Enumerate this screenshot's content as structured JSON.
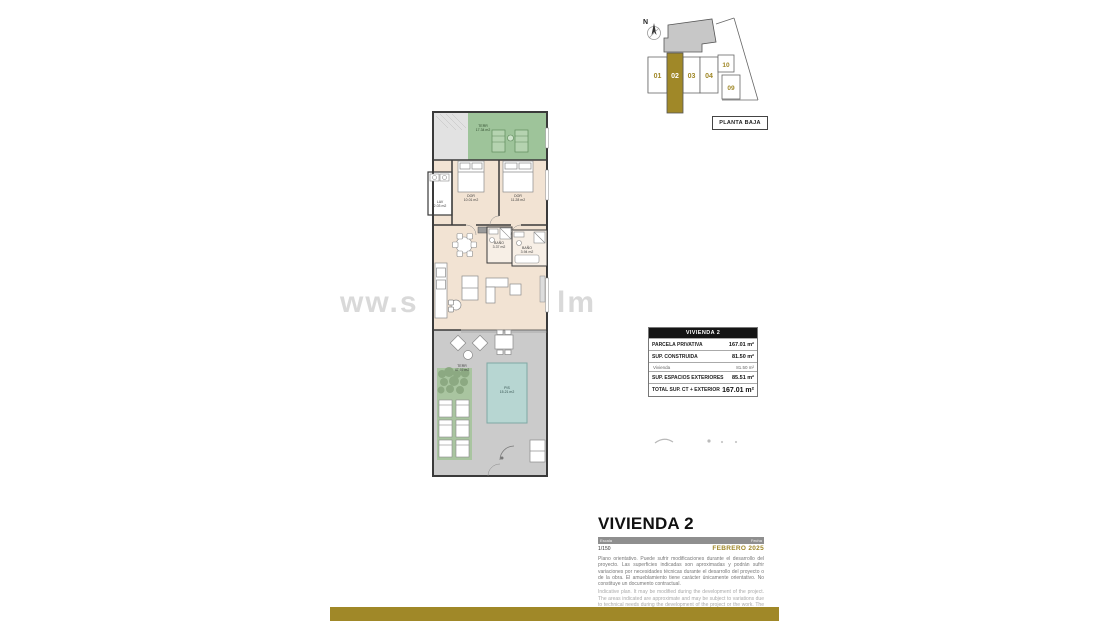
{
  "keyplan": {
    "north_label": "N",
    "units": [
      {
        "label": "01",
        "highlighted": false
      },
      {
        "label": "02",
        "highlighted": true
      },
      {
        "label": "03",
        "highlighted": false
      },
      {
        "label": "04",
        "highlighted": false
      },
      {
        "label": "10",
        "highlighted": false
      },
      {
        "label": "09",
        "highlighted": false
      }
    ],
    "floor_label": "PLANTA BAJA"
  },
  "plan": {
    "rooms": {
      "terrace_top": {
        "name": "TERR",
        "area": "17.34 m2"
      },
      "bedroom_left": {
        "name": "DOR",
        "area": "10.01 m2"
      },
      "bedroom_right": {
        "name": "DOR",
        "area": "11.28 m2"
      },
      "laundry": {
        "name": "LAV",
        "area": "2.03 m2"
      },
      "bath_small": {
        "name": "BAÑO",
        "area": "3.37 m2"
      },
      "bath_main": {
        "name": "BAÑO",
        "area": "3.94 m2"
      },
      "terrace_bottom": {
        "name": "TERR",
        "area": "47.97 m2"
      },
      "pool": {
        "name": "PIS",
        "area": "15.21 m2"
      }
    }
  },
  "watermark": {
    "left": "ww.s",
    "right": "lm"
  },
  "area_table": {
    "header": "VIVIENDA 2",
    "rows": [
      {
        "label": "PARCELA PRIVATIVA",
        "value": "167.01 m²"
      },
      {
        "label": "SUP. CONSTRUIDA",
        "value": "81.50 m²"
      },
      {
        "label": "Vivienda",
        "value": "81.50 m²"
      },
      {
        "label": "SUP. ESPACIOS EXTERIORES",
        "value": "85.51 m²"
      },
      {
        "label": "TOTAL SUP. CT + EXTERIOR",
        "value": "167.01 m²"
      }
    ]
  },
  "titleblock": {
    "title": "VIVIENDA 2",
    "scale_label": "Escala",
    "scale_value": "1/150",
    "date_label": "Fecha",
    "date_value": "FEBRERO 2025",
    "disclaimer_es": "Plano orientativo. Puede sufrir modificaciones durante el desarrollo del proyecto. Las superficies indicadas son aproximadas y podrán sufrir variaciones por necesidades técnicas durante el desarrollo del proyecto o de la obra. El amueblamiento tiene carácter únicamente orientativo. No constituye un documento contractual.",
    "disclaimer_en": "Indicative plan. It may be modified during the development of the project. The areas indicated are approximate and may be subject to variations due to technical needs during the development of the project or the work. The furnishings are for guidance only. It does not constitute a contractual document."
  },
  "colors": {
    "gold_accent": "#a08828",
    "terrace_green": "#9ec49a",
    "interior_beige": "#f2e3d3",
    "exterior_gray": "#cbcbcb",
    "pool_teal": "#b7d6d2",
    "table_header_bg": "#141414"
  }
}
